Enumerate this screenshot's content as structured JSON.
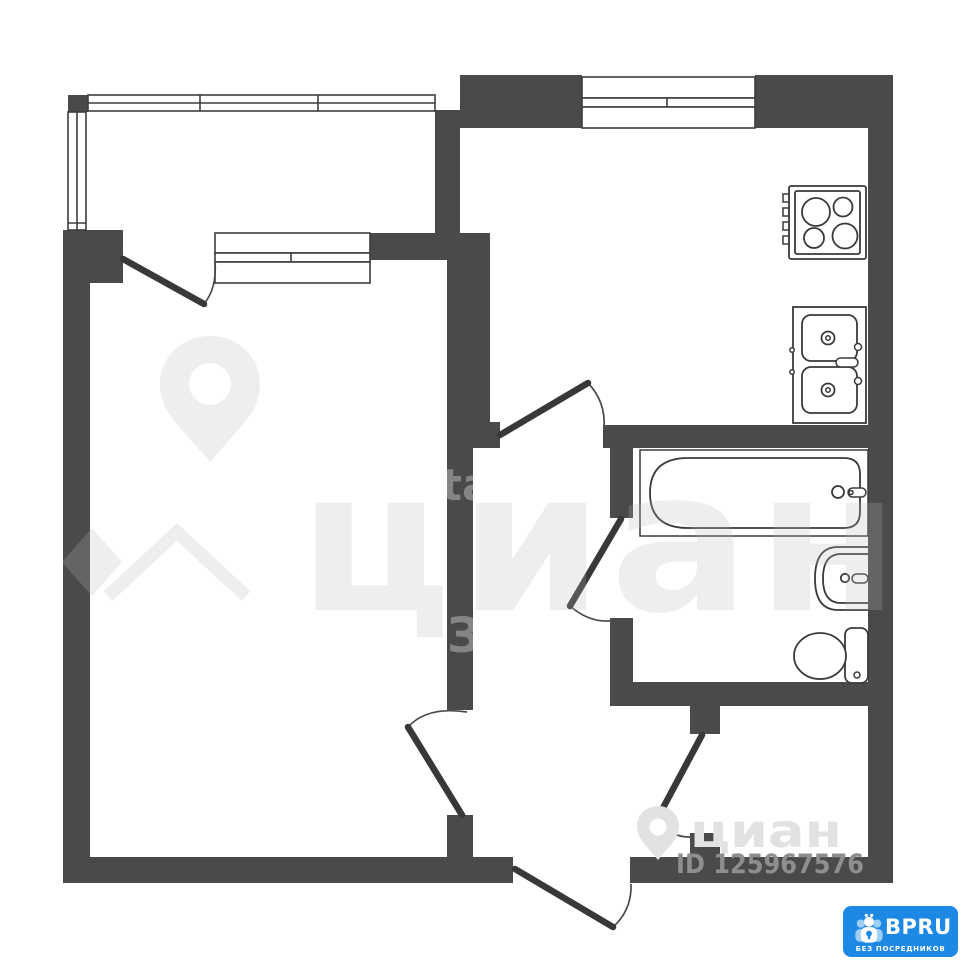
{
  "watermarks": {
    "center_text": "циан",
    "corner_text": "циан",
    "listing_id": "ID 125967576",
    "wall_fragment_1": "ta",
    "wall_fragment_2": "З"
  },
  "badge": {
    "brand": "BPRU",
    "tagline": "БЕЗ ПОСРЕДНИКОВ"
  },
  "colors": {
    "wall": "#4a4a4a",
    "fixture_line": "#3a3a3a",
    "door_line": "#383838",
    "badge_blue": "#1e88e5",
    "id_text_gray": "#8e8e8e",
    "corner_watermark_gray": "#e2e2e2"
  },
  "fixtures": [
    "stove-icon",
    "double-sink-icon",
    "bathtub-icon",
    "washbasin-icon",
    "toilet-icon"
  ]
}
